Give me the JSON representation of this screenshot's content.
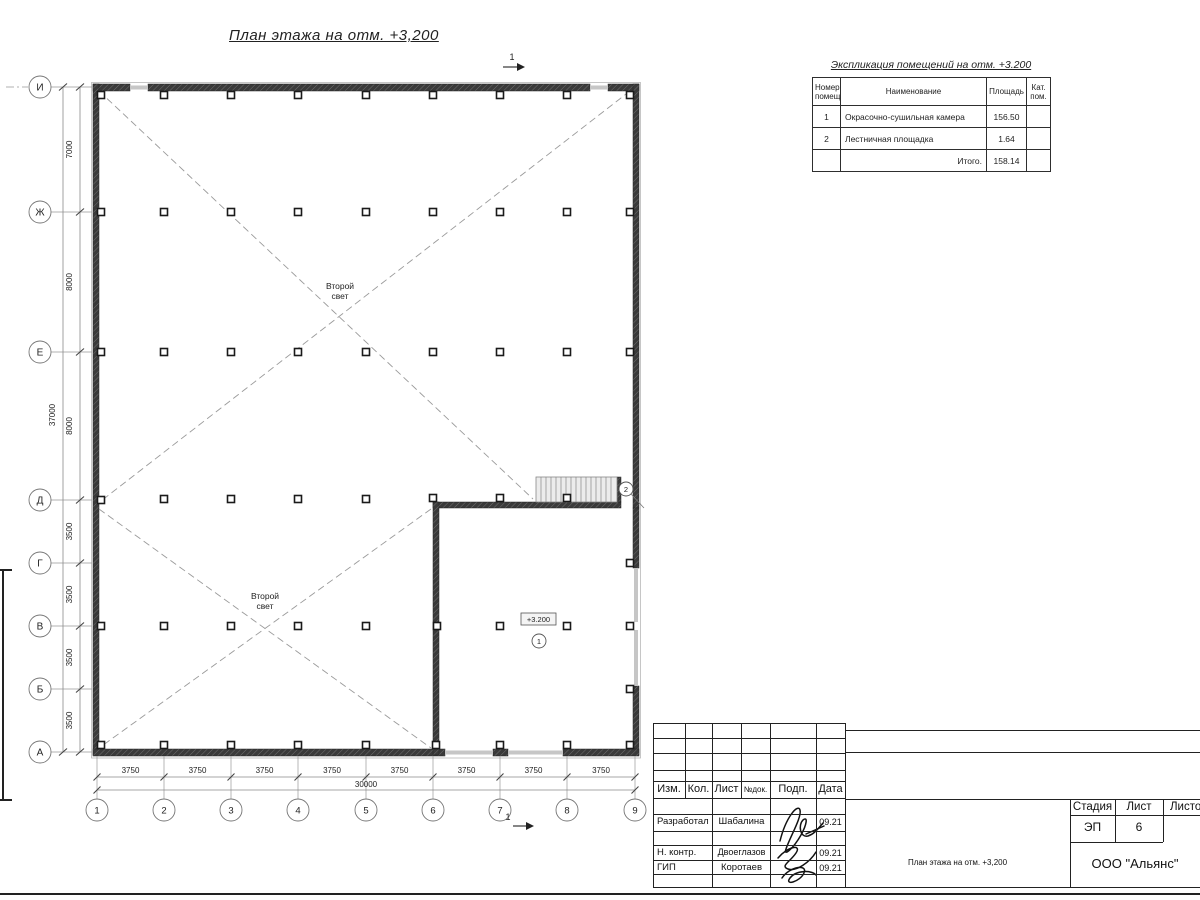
{
  "page_title": "План этажа на отм. +3,200",
  "section_mark_label": "1",
  "annotations": {
    "second_light_line1": "Второй",
    "second_light_line2": "свет",
    "elevation_label": "+3.200",
    "room_mark_1": "1",
    "room_mark_2": "2"
  },
  "axes": {
    "rows": [
      "И",
      "Ж",
      "Е",
      "Д",
      "Г",
      "В",
      "Б",
      "А"
    ],
    "cols": [
      "1",
      "2",
      "3",
      "4",
      "5",
      "6",
      "7",
      "8",
      "9"
    ]
  },
  "dims": {
    "left": [
      "7000",
      "8000",
      "8000",
      "3500",
      "3500",
      "3500",
      "3500"
    ],
    "left_total": "37000",
    "bottom": [
      "3750",
      "3750",
      "3750",
      "3750",
      "3750",
      "3750",
      "3750",
      "3750"
    ],
    "bottom_total": "30000"
  },
  "schedule": {
    "title": "Экспликация помещений на отм. +3.200",
    "headers": [
      "Номер помещ.",
      "Наименование",
      "Площадь",
      "Кат. пом."
    ],
    "rows": [
      {
        "num": "1",
        "name": "Окрасочно-сушильная камера",
        "area": "156.50",
        "cat": ""
      },
      {
        "num": "2",
        "name": "Лестничная площадка",
        "area": "1.64",
        "cat": ""
      }
    ],
    "total_label": "Итого.",
    "total_value": "158.14"
  },
  "titleblock": {
    "header_cols": [
      "Изм.",
      "Кол.",
      "Лист",
      "№док.",
      "Подп.",
      "Дата"
    ],
    "staff": [
      {
        "role": "Разработал",
        "name": "Шабалина",
        "date": "09.21"
      },
      {
        "role": "Н. контр.",
        "name": "Двоеглазов",
        "date": "09.21"
      },
      {
        "role": "ГИП",
        "name": "Коротаев",
        "date": "09.21"
      }
    ],
    "stage_label": "Стадия",
    "stage_value": "ЭП",
    "sheet_label": "Лист",
    "sheet_value": "6",
    "sheets_label": "Листов",
    "doc_title": "План этажа на отм. +3,200",
    "company": "ООО \"Альянс\""
  },
  "colors": {
    "wall": "#3a3a3a",
    "wall_hatch": "#7d7d7d",
    "opening": "#c6c6c6",
    "thin_line": "#555555",
    "dim_line": "#8a8a8a",
    "dashed": "#9a9a9a",
    "text": "#222222"
  }
}
